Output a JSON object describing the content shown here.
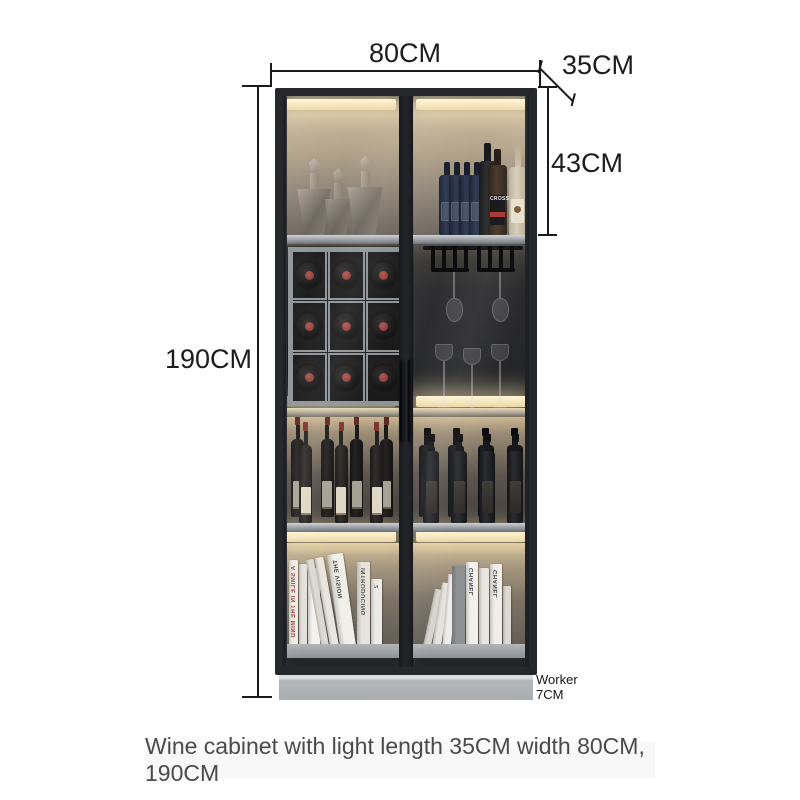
{
  "annotations": {
    "width_label": "80CM",
    "depth_label": "35CM",
    "top_section_label": "43CM",
    "height_label": "190CM",
    "plinth_label_line1": "Worker",
    "plinth_label_line2": "7CM",
    "line_color": "#1a1a1a"
  },
  "caption": {
    "text": "Wine cabinet with light length 35CM width 80CM, 190CM"
  },
  "cabinet": {
    "frame_color": "#26282c",
    "shelf_color": "#9aa0a5",
    "led_color": "#f6e7bb",
    "plinth_color": "#b4b7ba",
    "wine_rack": {
      "rows": 3,
      "cols": 3,
      "frame_color": "#8f9499",
      "cap_color": "#8d3a38"
    },
    "glasses": {
      "hanging": 2,
      "standing": 3
    },
    "top_shelf_bottles": [
      {
        "type": "blue"
      },
      {
        "type": "blue"
      },
      {
        "type": "blue"
      },
      {
        "type": "blue"
      },
      {
        "type": "dark"
      },
      {
        "type": "cross",
        "label": "CROSS",
        "accent": "#c2342e"
      },
      {
        "type": "cream"
      }
    ],
    "standing_bottles": {
      "left_back": 4,
      "left_front": 3,
      "right_back": 4,
      "right_front": 4
    },
    "books_left": [
      {
        "w": 9,
        "h": 86,
        "bg": "#efece6",
        "tilt": 0,
        "title": "A SMILE IN THE MIND",
        "tc": "#a03a35"
      },
      {
        "w": 8,
        "h": 82,
        "bg": "#e3e0da",
        "tilt": 0,
        "title": "",
        "tc": ""
      },
      {
        "w": 12,
        "h": 78,
        "bg": "#f4f2ee",
        "tilt": 0,
        "title": "loop",
        "tc": "#1d1d1d"
      },
      {
        "w": 8,
        "h": 88,
        "bg": "#dcd9d2",
        "tilt": -10,
        "title": "",
        "tc": ""
      },
      {
        "w": 9,
        "h": 90,
        "bg": "#e9e6e0",
        "tilt": -10,
        "title": "",
        "tc": ""
      },
      {
        "w": 16,
        "h": 93,
        "bg": "#f1efe9",
        "tilt": -8,
        "title": "THE VISION",
        "tc": "#3a3a3a"
      },
      {
        "w": 13,
        "h": 84,
        "bg": "#e6e3dc",
        "tilt": 0,
        "title": "INTRODUCING",
        "tc": "#55504a"
      },
      {
        "w": 11,
        "h": 67,
        "bg": "#eceae4",
        "tilt": 0,
        "title": "2",
        "tc": "#666"
      }
    ],
    "books_right": [
      {
        "w": 8,
        "h": 58,
        "bg": "#d8d5ce",
        "tilt": 12,
        "title": "",
        "tc": ""
      },
      {
        "w": 9,
        "h": 64,
        "bg": "#e6e3dd",
        "tilt": 9,
        "title": "",
        "tc": ""
      },
      {
        "w": 9,
        "h": 72,
        "bg": "#efede7",
        "tilt": 5,
        "title": "",
        "tc": ""
      },
      {
        "w": 13,
        "h": 80,
        "bg": "#8e9092",
        "tilt": 0,
        "title": "",
        "tc": ""
      },
      {
        "w": 12,
        "h": 84,
        "bg": "#f2f0ec",
        "tilt": 0,
        "title": "CHANEL",
        "tc": "#3c3c3c"
      },
      {
        "w": 10,
        "h": 78,
        "bg": "#e9e6e0",
        "tilt": 0,
        "title": "",
        "tc": ""
      },
      {
        "w": 12,
        "h": 82,
        "bg": "#f0eee9",
        "tilt": 0,
        "title": "CHANEL",
        "tc": "#3c3c3c"
      },
      {
        "w": 8,
        "h": 60,
        "bg": "#ddd9d2",
        "tilt": 0,
        "title": "",
        "tc": ""
      }
    ]
  }
}
